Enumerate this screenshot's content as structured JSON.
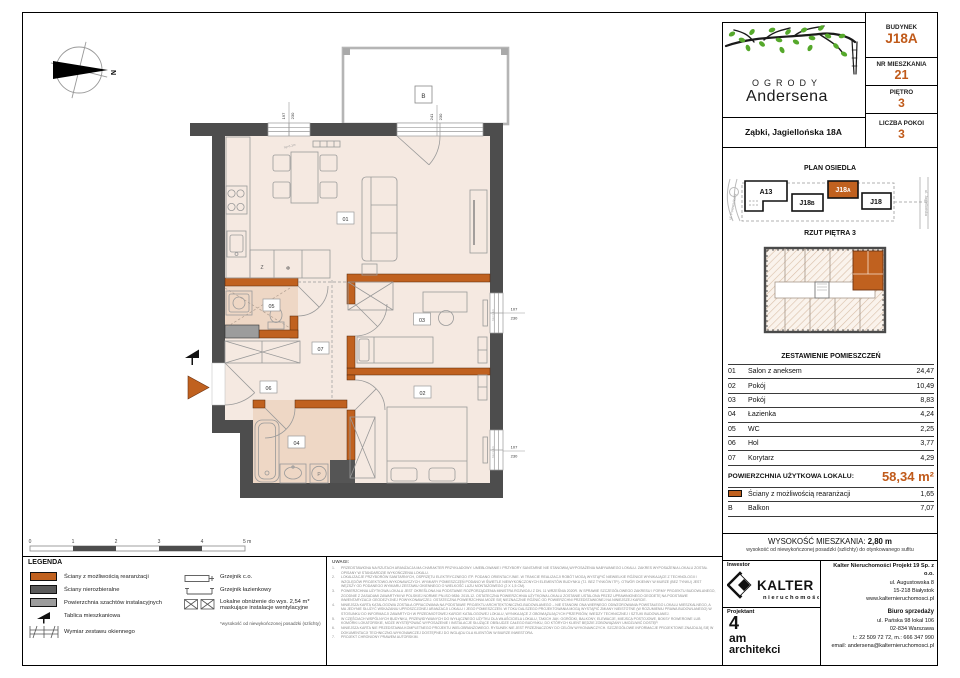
{
  "colors": {
    "accent": "#c05a1a",
    "wall_orange": "#c0611f",
    "wall_dark": "#4d4d4d",
    "shaft_gray": "#9c9c9c",
    "room_fill": "#f5e9e1",
    "bath_fill": "#eed7c5"
  },
  "logo": {
    "line1": "OGRODY",
    "line2": "Andersena"
  },
  "address_bar": "Ząbki, Jagiellońska 18A",
  "unit_info": {
    "rows": [
      {
        "label": "BUDYNEK",
        "value": "J18A"
      },
      {
        "label": "NR MIESZKANIA",
        "value": "21"
      },
      {
        "label": "PIĘTRO",
        "value": "3"
      },
      {
        "label": "LICZBA POKOI",
        "value": "3"
      }
    ]
  },
  "site_plan": {
    "title": "PLAN OSIEDLA",
    "buildings": [
      {
        "main": "A13",
        "sub": ""
      },
      {
        "main": "J18",
        "sub": "B"
      },
      {
        "main": "J18",
        "sub": "A"
      },
      {
        "main": "J18",
        "sub": ""
      }
    ],
    "street_left": "ul. Powstańców",
    "street_right": "ul. Jagiellońska"
  },
  "floor_overview": {
    "title": "RZUT PIĘTRA 3"
  },
  "rooms_table": {
    "title": "ZESTAWIENIE POMIESZCZEŃ",
    "rows": [
      {
        "no": "01",
        "name": "Salon z aneksem",
        "area": "24,47"
      },
      {
        "no": "02",
        "name": "Pokój",
        "area": "10,49"
      },
      {
        "no": "03",
        "name": "Pokój",
        "area": "8,83"
      },
      {
        "no": "04",
        "name": "Łazienka",
        "area": "4,24"
      },
      {
        "no": "05",
        "name": "WC",
        "area": "2,25"
      },
      {
        "no": "06",
        "name": "Hol",
        "area": "3,77"
      },
      {
        "no": "07",
        "name": "Korytarz",
        "area": "4,29"
      }
    ],
    "total_label": "POWIERZCHNIA UŻYTKOWA LOKALU:",
    "total_value": "58,34 m²",
    "extras": [
      {
        "no": "",
        "name": "Ściany z możliwością rearanżacji",
        "area": "1,65"
      },
      {
        "no": "B",
        "name": "Balkon",
        "area": "7,07"
      }
    ]
  },
  "height_info": {
    "label": "WYSOKOŚĆ MIESZKANIA:",
    "value": "2,80 m",
    "note": "wysokość od niewykończonej posadzki (szlichty) do otynkowanego sufitu"
  },
  "legend": {
    "title": "LEGENDA",
    "col1": [
      "Ściany z możliwością rearanżacji",
      "Ściany nierozbieralne",
      "Powierzchnia szachtów instalacyjnych",
      "Tablica mieszkaniowa",
      "Wymiar zestawu okiennego"
    ],
    "col2": [
      "Grzejnik c.o.",
      "Grzejnik łazienkowy",
      "Lokalne obniżenie do wys. 2,54 m* maskujące instalacje wentylacyjne"
    ],
    "footnote": "*wysokość od niewykończonej posadzki (szlichty)"
  },
  "notes": {
    "title": "UWAGI:",
    "items": [
      {
        "n": "1.",
        "t": "PRZEDSTAWIONA NA RZUTACH ARANŻACJA MA CHARAKTER PRZYKŁADOWY. UMEBLOWANIE I PRZYBORY SANITARNE NIE STANOWIĄ WYPOSAŻENIA NABYWANEGO LOKALU. ZAKRES WYPOSAŻENIA LOKALU ZOSTAŁ OPISANY W STANDARDZIE WYKOŃCZENIA LOKALU."
      },
      {
        "n": "2.",
        "t": "LOKALIZACJE PRZYBORÓW SANITARNYCH, OSPRZĘTU ELEKTRYCZNEGO ITP. PODANO ORIENTACYJNIE. W TRAKCIE REALIZACJI ROBÓT MOGĄ WYSTĄPIĆ NIEWIELKIE RÓŻNICE WYNIKAJĄCE Z TECHNOLOGII I WZGLĘDÓW PROJEKTOWO-WYKONAWCZYCH. WYMIARY POMIESZCZEŃ PODANO W ŚWIETLE NIEWYKOŃCZONYCH ELEMENTÓW BUDYNKU (TJ. BEZ TYNKÓW ITP.). OTWÓR OKIENNY W MURZE (BEZ TYNKU) JEST WĘŻSZY OD PODANEGO WYMIARU ZESTAWU OKIENNEGO O WIELKOŚĆ LUZU MONTAŻOWEGO (2 X 1,5 CM)."
      },
      {
        "n": "3.",
        "t": "POWIERZCHNIA UŻYTKOWA LOKALU JEST OKREŚLONA NA PODSTAWIE ROZPORZĄDZENIA MINISTRA ROZWOJU Z DN. 11 WRZEŚNIA 2020R. W SPRAWIE SZCZEGÓŁOWEGO ZAKRESU I FORMY PROJEKTU BUDOWLANEGO, ZGODNIE Z ZASADAMI ZAWARTYMI W POLSKIEJ NORMIE PN-ISO 9836: 2015-12. OSTATECZNA POWIERZCHNIA UŻYTKOWA LOKALU ZOSTANIE USTALONA PRZEZ UPRAWNIONEGO GEODETĘ NA PODSTAWIE INWENTARYZACJI GEODEZYJNEJ POWYKONAWCZEJ. OSTATECZNA POWIERZCHNIA MOŻE SIĘ NIEZNACZNIE RÓŻNIĆ OD POWIERZCHNI PRZEDSTAWIONEJ NA NINIEJSZEJ KARCIE."
      },
      {
        "n": "4.",
        "t": "NINIEJSZA KARTA KATALOGOWA ZOSTAŁA OPRACOWANA NA PODSTAWIE PROJEKTU ARCHITEKTONICZNO-BUDOWLANEGO – NIE STANOWI ONA WIERNEGO ODWZOROWANIA POWSTAŁEGO LOKALU MIESZKALNEGO, A MA JEDYNIE SŁUŻYĆ WSKAZANIU UPROSZCZONEJ ARANŻACJI LOKALU I JEGO POMIESZCZEŃ. W TOKU DALSZEGO PROJEKTOWANIA MOGĄ WYSTĄPIĆ ZMIANY NIEISTOTNE (W ROZUMIENIU PRAWA BUDOWLANEGO) W STOSUNKU DO INFORMACJI ZAWARTYCH W PRZEDMIOTOWEJ KARCIE KATALOGOWEJ LOKALU, WYNIKAJĄCE Z OBOWIĄZUJĄCYCH PRZEPISÓW, WIEDZY TECHNICZNEJ I SZTUKI BUDOWLANEJ."
      },
      {
        "n": "5.",
        "t": "W CZĘŚCIACH WSPÓLNYCH BUDYNKU, PRZEWIDYWANYCH DO WYŁĄCZNEGO UŻYTKU DLA WŁAŚCICIELA LOKALU, TAKICH JAK: OGRÓDKI, BALKONY, ELEWACJE, MIEJSCA POSTOJOWE, BOKSY ROWEROWE LUB KOMÓRKI LOKATORSKIE, MOŻE WYSTĘPOWAĆ WYPOSAŻENIE I INSTALACJE SŁUŻĄCE OBSŁUDZE CAŁEGO BUDYNKU, DO KTÓRYCH KLIENT BĘDZIE ZOBOWIĄZANY UMOŻLIWIĆ DOSTĘP."
      },
      {
        "n": "6.",
        "t": "NINIEJSZA KARTA NIE PRZEDSTAWIA KOMPLETNEGO PROJEKTU WIELOBRANŻOWEGO. RYSUNEK NIE JEST PRZEZNACZONY DO CELÓW WYKONAWCZYCH. SZCZEGÓŁOWE INFORMACJE PROJEKTOWE ZNAJDUJĄ SIĘ W DOKUMENTACJI TECHNICZNO-WYKONAWCZEJ DOSTĘPNEJ DO WGLĄDU DLA KLIENTÓW W BIURZE INWESTORA."
      },
      {
        "n": "7.",
        "t": "PROJEKT CHRONIONY PRAWEM AUTORSKIM."
      }
    ]
  },
  "credits": {
    "investor_label": "Inwestor",
    "brand": "KALTER",
    "brand_sub": "nieruchomości",
    "company": "Kalter Nieruchomości Projekt 19 Sp. z o.o.",
    "company_lines": [
      "ul. Augustowska 8",
      "15-218 Białystok",
      "www.kalternieruchomosci.pl"
    ],
    "sales_label": "Biuro sprzedaży",
    "sales_lines": [
      "ul. Pańska 98 lokal 106",
      "02-834 Warszawa",
      "t.: 22 509 72 72, m.: 666 347 990",
      "email: andersena@kalternieruchomosci.pl"
    ],
    "designer_label": "Projektant",
    "studio_lines": [
      "4",
      "am",
      "architekci"
    ]
  },
  "plan": {
    "north": "N",
    "labels": {
      "r01": "01",
      "r02": "02",
      "r03": "03",
      "r04": "04",
      "r05": "05",
      "r06": "06",
      "r07": "07",
      "balcony": "B"
    },
    "kitchen": {
      "dishwasher": "Z",
      "fridge": "❄"
    },
    "fixtures": {
      "washer": "P"
    },
    "dims": {
      "w_top_left": [
        "197",
        "230"
      ],
      "w_balcony": [
        "241",
        "230"
      ],
      "w_right_1": [
        "107",
        "230"
      ],
      "w_right_2": [
        "107",
        "230"
      ],
      "sill": "hp=1,1m"
    },
    "scale": [
      "0",
      "1",
      "2",
      "3",
      "4",
      "5 m"
    ]
  }
}
